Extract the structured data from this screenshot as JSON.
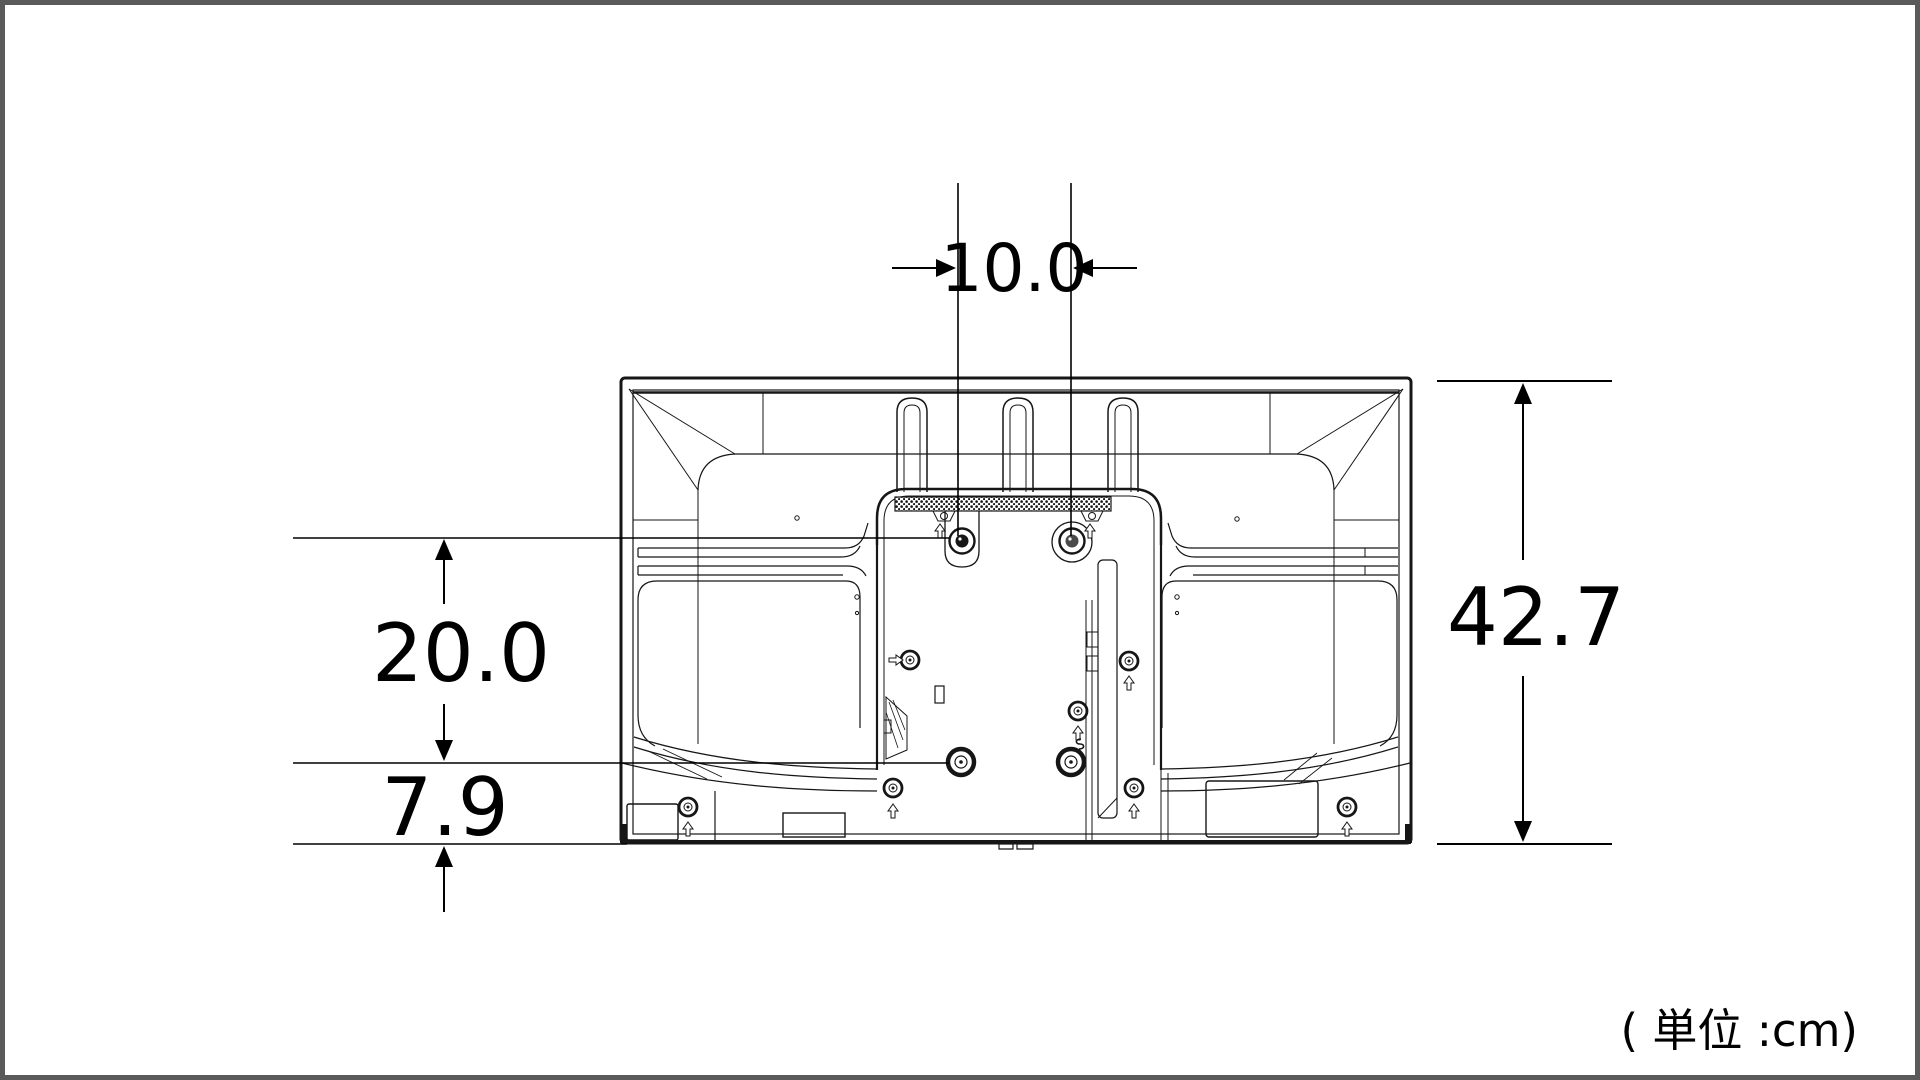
{
  "diagram": {
    "type": "tv-rear-view-dimension-drawing",
    "unit_note": "( 単位 :cm)",
    "dimensions": {
      "mount_hole_spacing_horizontal": "10.0",
      "mount_hole_spacing_vertical": "20.0",
      "bottom_offset": "7.9",
      "total_height": "42.7"
    }
  },
  "colors": {
    "background": "#ffffff",
    "page_border": "#5a5a5a",
    "drawing_line": "#161616",
    "dimension_line": "#000000"
  }
}
